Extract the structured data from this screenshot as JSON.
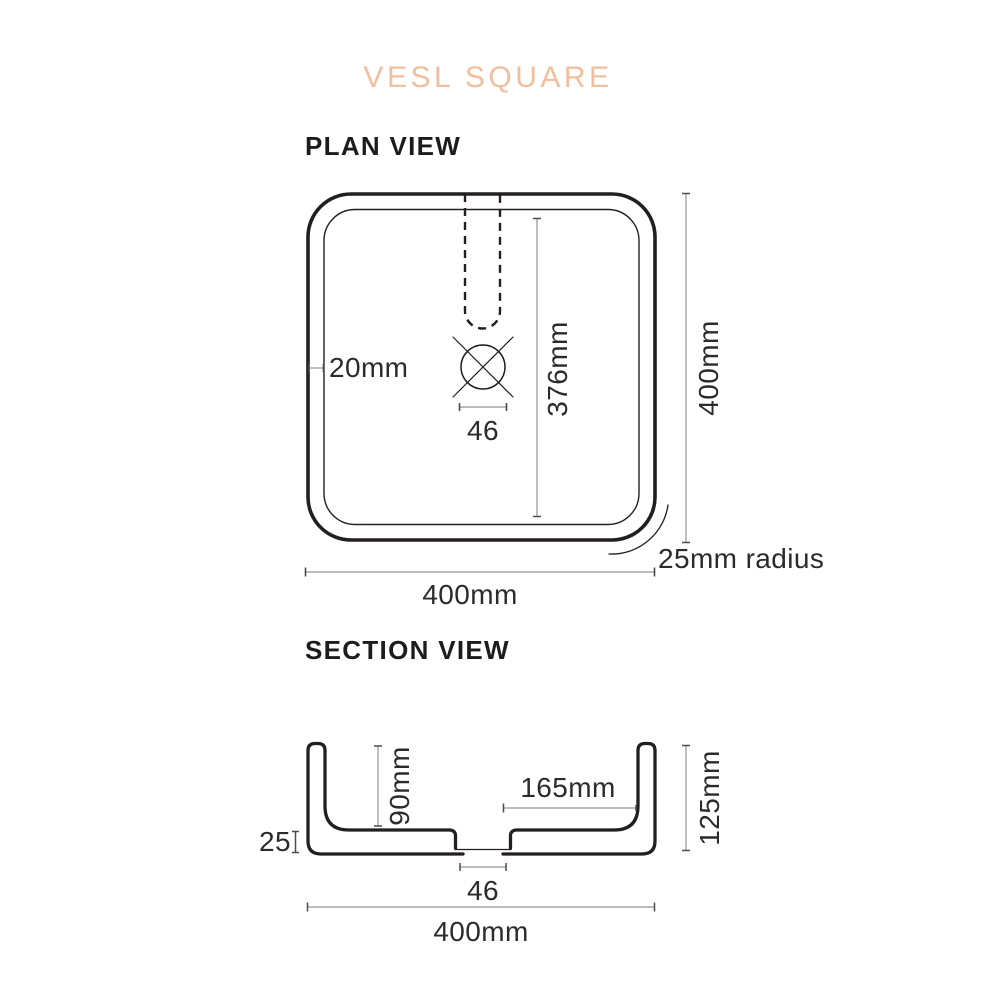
{
  "title": "VESL SQUARE",
  "colors": {
    "accent": "#F1BE9E",
    "ink": "#231F20",
    "dimension_line": "#949494",
    "dimension_tick": "#4C4C4C"
  },
  "plan": {
    "heading": "PLAN VIEW",
    "labels": {
      "rim_thickness": "20mm",
      "drain_width": "46",
      "inner_length": "376mm",
      "overall_height": "400mm",
      "overall_width": "400mm",
      "corner_radius": "25mm radius"
    }
  },
  "section": {
    "heading": "SECTION VIEW",
    "labels": {
      "base_thickness": "25",
      "bowl_depth": "90mm",
      "base_half_width": "165mm",
      "overall_height": "125mm",
      "drain_width": "46",
      "overall_width": "400mm"
    }
  }
}
